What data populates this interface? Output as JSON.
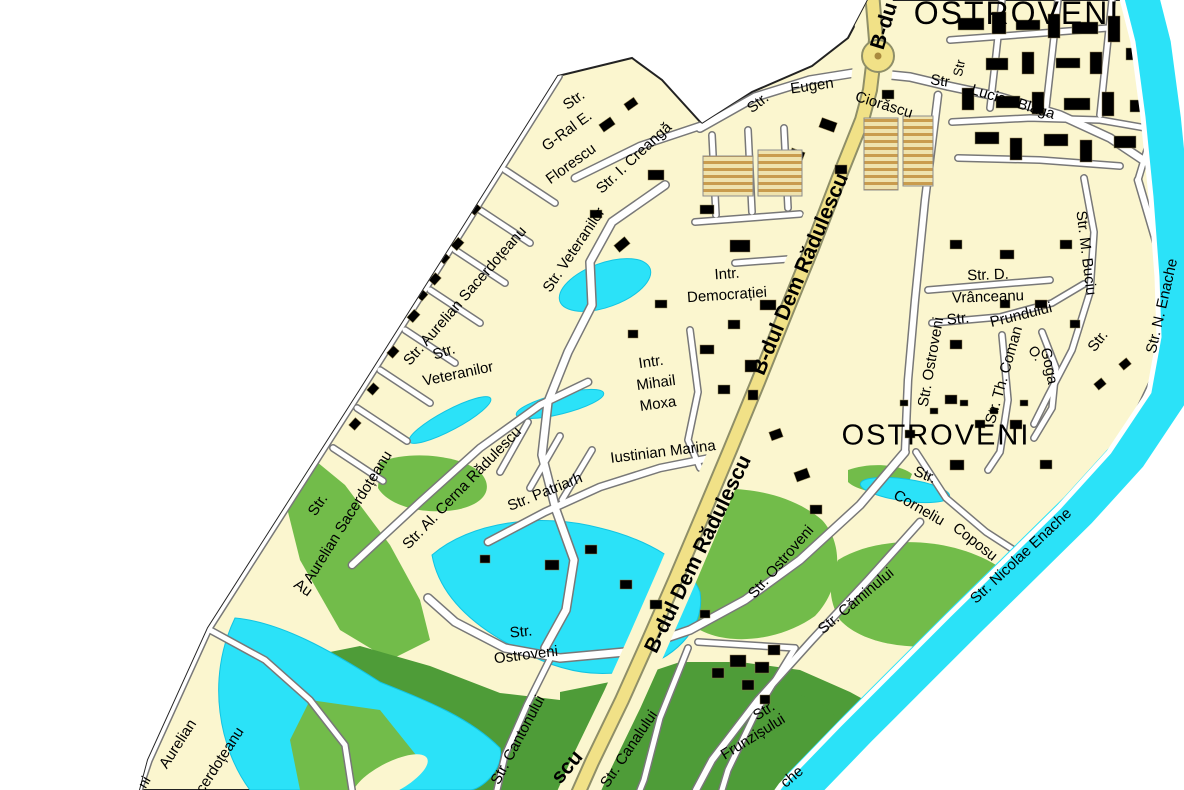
{
  "map": {
    "title": "Ostroveni district street map",
    "colors": {
      "background": "#ffffff",
      "land": "#FBF6CF",
      "water": "#2BE2F8",
      "park": "#72BC4A",
      "forest": "#4E9C38",
      "road_fill": "#FFFFFF",
      "road_casing": "#787878",
      "boulevard": "#F1E187",
      "boulevard_casing": "#8F8F68",
      "building_tan": "#E19E4F",
      "building_khaki": "#D2C582",
      "label_color": "#000000"
    },
    "region_titles": [
      {
        "name": "region-title-ostroveni-north",
        "text": "OSTROVENI",
        "x": 1017,
        "y": 13,
        "rot": 0,
        "size": 32,
        "weight": 400,
        "ls": 2
      },
      {
        "name": "region-title-ostroveni-south",
        "text": "OSTROVENI",
        "x": 936,
        "y": 436,
        "rot": 0,
        "size": 29,
        "weight": 400,
        "ls": 2
      }
    ],
    "boulevard_labels": [
      {
        "name": "blvd-label-partial-top",
        "text": "B-du",
        "x": 884,
        "y": 26,
        "rot": -73,
        "size": 21,
        "weight": 700
      },
      {
        "name": "blvd-label-upper",
        "text": "B-dul Dem Rădulescu",
        "x": 800,
        "y": 274,
        "rot": -67,
        "size": 21,
        "weight": 700
      },
      {
        "name": "blvd-label-lower",
        "text": "B-dul Dem Rădulescu",
        "x": 698,
        "y": 554,
        "rot": -64,
        "size": 21,
        "weight": 700
      },
      {
        "name": "blvd-label-partial-bottom",
        "text": "scu",
        "x": 567,
        "y": 767,
        "rot": -50,
        "size": 21,
        "weight": 700
      }
    ],
    "street_labels": [
      {
        "text": "Str.",
        "x": 758,
        "y": 103,
        "rot": -38,
        "size": 15
      },
      {
        "text": "Eugen",
        "x": 812,
        "y": 86,
        "rot": -8,
        "size": 15
      },
      {
        "text": "Ciorăscu",
        "x": 884,
        "y": 105,
        "rot": 17,
        "size": 15
      },
      {
        "text": "Str",
        "x": 940,
        "y": 81,
        "rot": 8,
        "size": 15
      },
      {
        "text": "Str",
        "x": 959,
        "y": 68,
        "rot": -78,
        "size": 13
      },
      {
        "text": "Lucian Blaga",
        "x": 1013,
        "y": 102,
        "rot": 17,
        "size": 15
      },
      {
        "text": "Str.",
        "x": 574,
        "y": 100,
        "rot": -36,
        "size": 15
      },
      {
        "text": "G-Ral E.",
        "x": 567,
        "y": 131,
        "rot": -36,
        "size": 15
      },
      {
        "text": "Florescu",
        "x": 571,
        "y": 164,
        "rot": -36,
        "size": 15
      },
      {
        "text": "Str. I. Creangă",
        "x": 634,
        "y": 158,
        "rot": -43,
        "size": 15
      },
      {
        "text": "Str. Aurelian Sacerdoțeanu",
        "x": 465,
        "y": 296,
        "rot": -49,
        "size": 15
      },
      {
        "text": "Str. Veteranilor",
        "x": 574,
        "y": 250,
        "rot": -56,
        "size": 15
      },
      {
        "text": "Str.",
        "x": 444,
        "y": 352,
        "rot": -18,
        "size": 15
      },
      {
        "text": "Veteranilor",
        "x": 458,
        "y": 374,
        "rot": -12,
        "size": 15
      },
      {
        "text": "Intr.",
        "x": 727,
        "y": 274,
        "rot": -4,
        "size": 15
      },
      {
        "text": "Democrației",
        "x": 727,
        "y": 295,
        "rot": -4,
        "size": 15
      },
      {
        "text": "Intr.",
        "x": 651,
        "y": 362,
        "rot": -8,
        "size": 15
      },
      {
        "text": "Mihail",
        "x": 656,
        "y": 383,
        "rot": -8,
        "size": 15
      },
      {
        "text": "Moxa",
        "x": 658,
        "y": 404,
        "rot": -8,
        "size": 15
      },
      {
        "text": "Str. Ostroveni",
        "x": 931,
        "y": 362,
        "rot": -80,
        "size": 15
      },
      {
        "text": "Str. D.",
        "x": 988,
        "y": 275,
        "rot": -2,
        "size": 15
      },
      {
        "text": "Vrânceanu",
        "x": 988,
        "y": 297,
        "rot": -2,
        "size": 15
      },
      {
        "text": "Str.",
        "x": 958,
        "y": 319,
        "rot": -6,
        "size": 15
      },
      {
        "text": "Prundului",
        "x": 1021,
        "y": 315,
        "rot": -14,
        "size": 15
      },
      {
        "text": "Str. Th. Coman",
        "x": 1004,
        "y": 375,
        "rot": -74,
        "size": 15
      },
      {
        "text": "O.",
        "x": 1036,
        "y": 353,
        "rot": 55,
        "size": 14
      },
      {
        "text": "Goga",
        "x": 1049,
        "y": 366,
        "rot": 78,
        "size": 15
      },
      {
        "text": "Str.",
        "x": 1098,
        "y": 341,
        "rot": -52,
        "size": 15
      },
      {
        "text": "Str. M. Buciu",
        "x": 1086,
        "y": 253,
        "rot": 83,
        "size": 15
      },
      {
        "text": "Str. N. Enache",
        "x": 1162,
        "y": 306,
        "rot": -77,
        "size": 15
      },
      {
        "text": "Str. Patriarh",
        "x": 545,
        "y": 492,
        "rot": -22,
        "size": 15
      },
      {
        "text": "Iustinian Marina",
        "x": 663,
        "y": 452,
        "rot": -7,
        "size": 15
      },
      {
        "text": "Str. Al. Cerna Rădulescu",
        "x": 462,
        "y": 488,
        "rot": -46,
        "size": 15
      },
      {
        "text": "Str.",
        "x": 318,
        "y": 505,
        "rot": -56,
        "size": 15
      },
      {
        "text": "Aurelian Sacerdoțeanu",
        "x": 348,
        "y": 517,
        "rot": -58,
        "size": 15
      },
      {
        "text": "Str. Ostroveni",
        "x": 781,
        "y": 562,
        "rot": -49,
        "size": 15
      },
      {
        "text": "Str.",
        "x": 925,
        "y": 475,
        "rot": 22,
        "size": 15
      },
      {
        "text": "Corneliu",
        "x": 919,
        "y": 508,
        "rot": 30,
        "size": 15
      },
      {
        "text": "Coposu",
        "x": 975,
        "y": 542,
        "rot": 38,
        "size": 15
      },
      {
        "text": "Str. Nicolae Enache",
        "x": 1021,
        "y": 556,
        "rot": -43,
        "size": 15
      },
      {
        "text": "Str. Căminului",
        "x": 856,
        "y": 601,
        "rot": -40,
        "size": 15
      },
      {
        "text": "Str.",
        "x": 521,
        "y": 632,
        "rot": -6,
        "size": 15
      },
      {
        "text": "Ostroveni",
        "x": 526,
        "y": 655,
        "rot": -7,
        "size": 15
      },
      {
        "text": "Str. Cantonului",
        "x": 518,
        "y": 740,
        "rot": -62,
        "size": 15
      },
      {
        "text": "Str. Canalului",
        "x": 629,
        "y": 749,
        "rot": -56,
        "size": 15
      },
      {
        "text": "Str.",
        "x": 764,
        "y": 711,
        "rot": -32,
        "size": 15
      },
      {
        "text": "Frunzișului",
        "x": 753,
        "y": 737,
        "rot": -32,
        "size": 15
      },
      {
        "text": "che",
        "x": 792,
        "y": 777,
        "rot": -40,
        "size": 15
      },
      {
        "text": "Au",
        "x": 303,
        "y": 588,
        "rot": 35,
        "size": 15
      },
      {
        "text": "Aurelian",
        "x": 178,
        "y": 744,
        "rot": -57,
        "size": 15
      },
      {
        "text": "Sacerdoțeanu",
        "x": 215,
        "y": 768,
        "rot": -57,
        "size": 15
      },
      {
        "text": "ni",
        "x": 144,
        "y": 782,
        "rot": -60,
        "size": 14
      }
    ]
  }
}
